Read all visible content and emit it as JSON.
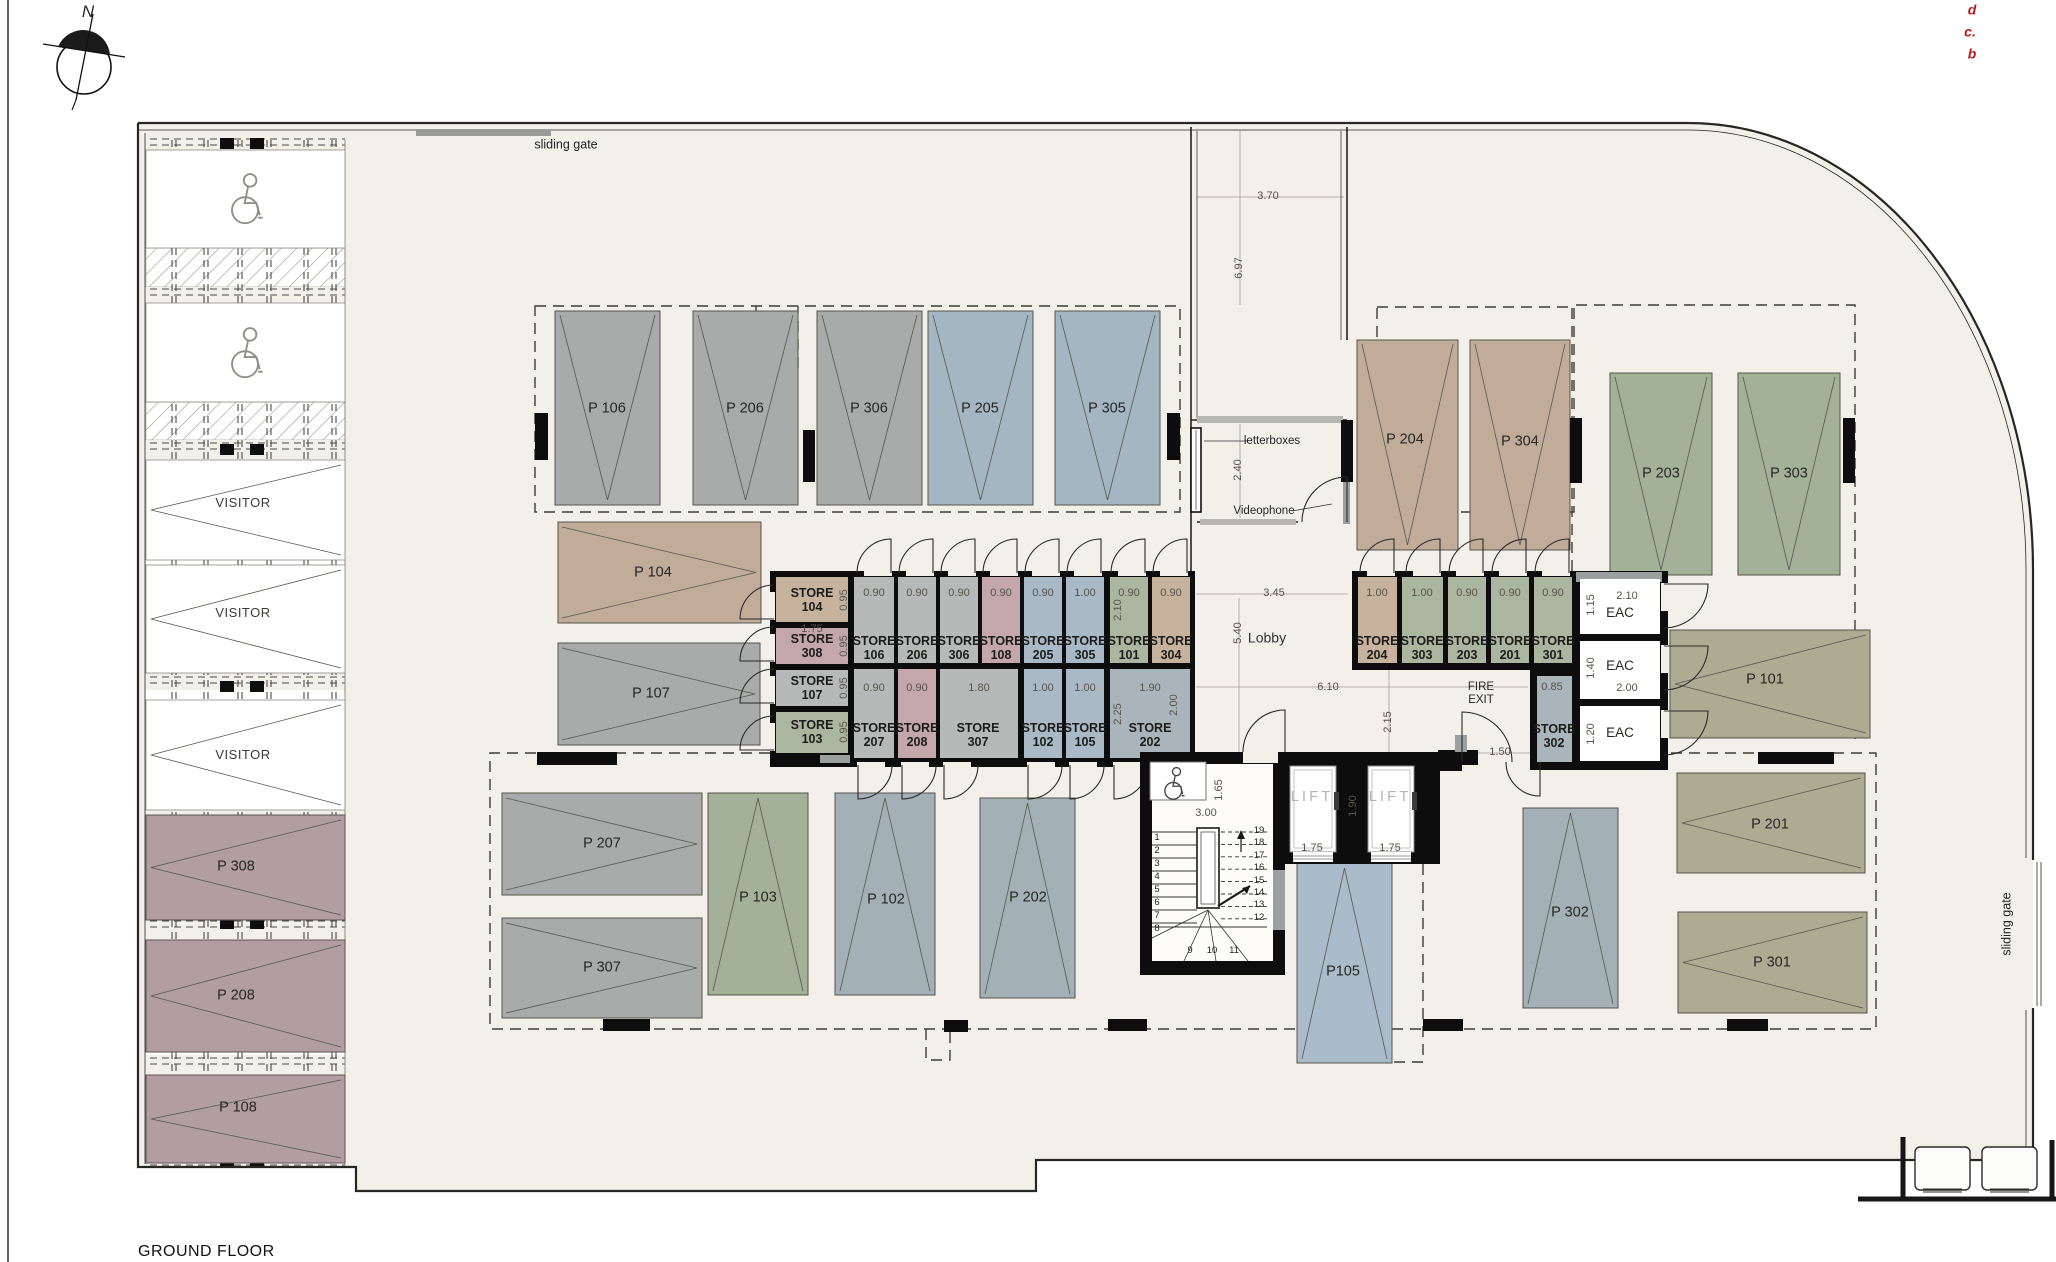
{
  "page": {
    "title": "GROUND FLOOR",
    "north": "N"
  },
  "revisions": [
    {
      "text": "d"
    },
    {
      "text": "c."
    },
    {
      "text": "b"
    }
  ],
  "gates": [
    {
      "text": "sliding gate"
    },
    {
      "text": "sliding gate"
    }
  ],
  "entrance": {
    "letterboxes": "letterboxes",
    "videophone": "Videophone"
  },
  "lobby": {
    "label": "Lobby"
  },
  "fire_exit": {
    "line1": "FIRE",
    "line2": "EXIT"
  },
  "visitor": {
    "label": "VISITOR"
  },
  "lifts": [
    {
      "label": "LIFT",
      "width": "1.75"
    },
    {
      "label": "LIFT",
      "width": "1.75"
    }
  ],
  "eac": [
    {
      "label": "EAC"
    },
    {
      "label": "EAC"
    },
    {
      "label": "EAC"
    }
  ],
  "parking": {
    "p106": "P 106",
    "p206": "P 206",
    "p306": "P 306",
    "p205": "P 205",
    "p305": "P 305",
    "p204": "P 204",
    "p304": "P 304",
    "p203": "P 203",
    "p303": "P 303",
    "p104": "P 104",
    "p107": "P 107",
    "p101": "P 101",
    "p207": "P 207",
    "p307": "P 307",
    "p103": "P 103",
    "p102": "P 102",
    "p202": "P 202",
    "p105": "P105",
    "p302": "P 302",
    "p201": "P 201",
    "p301": "P 301",
    "p308": "P 308",
    "p208": "P 208",
    "p108": "P 108"
  },
  "stores": {
    "s104": {
      "name": "STORE",
      "num": "104"
    },
    "s308": {
      "name": "STORE",
      "num": "308"
    },
    "s107": {
      "name": "STORE",
      "num": "107"
    },
    "s103": {
      "name": "STORE",
      "num": "103"
    },
    "s106": {
      "name": "STORE",
      "num": "106"
    },
    "s206": {
      "name": "STORE",
      "num": "206"
    },
    "s306": {
      "name": "STORE",
      "num": "306"
    },
    "s108": {
      "name": "STORE",
      "num": "108"
    },
    "s205": {
      "name": "STORE",
      "num": "205"
    },
    "s305": {
      "name": "STORE",
      "num": "305"
    },
    "s101": {
      "name": "STORE",
      "num": "101"
    },
    "s304": {
      "name": "STORE",
      "num": "304"
    },
    "s207": {
      "name": "STORE",
      "num": "207"
    },
    "s208": {
      "name": "STORE",
      "num": "208"
    },
    "s307": {
      "name": "STORE",
      "num": "307"
    },
    "s102": {
      "name": "STORE",
      "num": "102"
    },
    "s105": {
      "name": "STORE",
      "num": "105"
    },
    "s202": {
      "name": "STORE",
      "num": "202"
    },
    "s204": {
      "name": "STORE",
      "num": "204"
    },
    "s303": {
      "name": "STORE",
      "num": "303"
    },
    "s203": {
      "name": "STORE",
      "num": "203"
    },
    "s201": {
      "name": "STORE",
      "num": "201"
    },
    "s301": {
      "name": "STORE",
      "num": "301"
    },
    "s302": {
      "name": "STORE",
      "num": "302"
    }
  },
  "dims": {
    "t1": "0.90",
    "t2": "0.90",
    "t3": "0.90",
    "t4": "0.90",
    "t5": "0.90",
    "t6": "1.00",
    "t7": "0.90",
    "t8": "0.90",
    "b1": "0.90",
    "b2": "0.90",
    "b3": "1.80",
    "b4": "1.00",
    "b5": "1.00",
    "b6": "1.90",
    "l1": "0.95",
    "l2": "0.95",
    "l3": "0.95",
    "l4": "0.95",
    "l175": "1.75",
    "v210": "2.10",
    "v225": "2.25",
    "v200": "2.00",
    "r1": "1.00",
    "r2": "1.00",
    "r3": "0.90",
    "r4": "0.90",
    "r5": "0.90",
    "e_w1": "2.10",
    "e_h1": "1.15",
    "e_h2": "1.40",
    "e_w2": "2.00",
    "e_h3": "1.20",
    "c085": "0.85",
    "c150": "1.50",
    "c215": "2.15",
    "c610": "6.10",
    "c540": "5.40",
    "c345": "3.45",
    "c370": "3.70",
    "c697": "6.97",
    "c240": "2.40",
    "s300": "3.00",
    "s165": "1.65",
    "lf1": "1.75",
    "lf2": "1.75",
    "lf190": "1.90"
  },
  "stairs": {
    "steps": [
      "1",
      "2",
      "3",
      "4",
      "5",
      "6",
      "7",
      "8",
      "9",
      "10",
      "11",
      "12",
      "13",
      "14",
      "15",
      "16",
      "17",
      "18",
      "19"
    ]
  },
  "colors": {
    "plan_bg": "#f3f0e9",
    "wall": "#20201d",
    "accent_red": "#c01818",
    "stall_gray": "#a8abaa",
    "stall_blue": "#a4b6c2",
    "stall_tan": "#c0ac99",
    "stall_sage": "#a3b199",
    "stall_olive": "#adac93",
    "stall_bluegray": "#a3b0b6",
    "stall_lightblue": "#aabbca",
    "stall_mauve": "#b19da2",
    "store_gray": "#b6b9b8",
    "store_pink": "#c3a7aa",
    "store_blue": "#a9bac6",
    "store_green": "#abb6a0",
    "store_tan": "#c7b29d",
    "store_bluegray": "#a9b5ba"
  }
}
